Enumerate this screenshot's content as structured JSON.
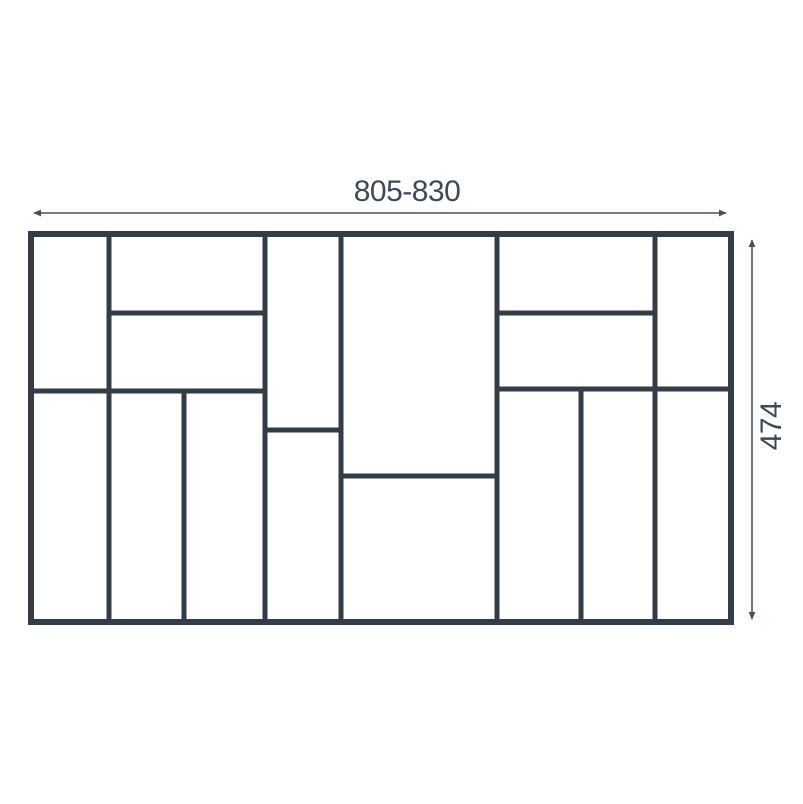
{
  "diagram": {
    "title": "cutlery tray compartment layout drawing",
    "width_dimension": "805-830",
    "height_dimension": "474",
    "compartment_count": 16,
    "colors": {
      "wall": "#333d47",
      "dimension_line": "#47515d",
      "label_text": "#3f4a59",
      "background": "#ffffff"
    },
    "outline": {
      "x": 31,
      "y": 234,
      "width": 700,
      "height": 388,
      "thickness": 6
    },
    "wall_thickness": 5,
    "walls": [
      {
        "name": "vertical-divider-1-full",
        "x1": 109,
        "y1": 234,
        "x2": 109,
        "y2": 622
      },
      {
        "name": "vertical-divider-2-lower",
        "x1": 184,
        "y1": 391,
        "x2": 184,
        "y2": 622
      },
      {
        "name": "vertical-divider-3-full",
        "x1": 265,
        "y1": 234,
        "x2": 265,
        "y2": 622
      },
      {
        "name": "vertical-divider-4-full",
        "x1": 341,
        "y1": 234,
        "x2": 341,
        "y2": 622
      },
      {
        "name": "vertical-divider-5-full",
        "x1": 497,
        "y1": 234,
        "x2": 497,
        "y2": 622
      },
      {
        "name": "vertical-divider-6-lower",
        "x1": 581,
        "y1": 389,
        "x2": 581,
        "y2": 622
      },
      {
        "name": "vertical-divider-7-full",
        "x1": 655,
        "y1": 234,
        "x2": 655,
        "y2": 622
      },
      {
        "name": "horizontal-divider-left-upper",
        "x1": 109,
        "y1": 313,
        "x2": 265,
        "y2": 313
      },
      {
        "name": "horizontal-divider-right-upper",
        "x1": 497,
        "y1": 313,
        "x2": 655,
        "y2": 313
      },
      {
        "name": "horizontal-divider-left-mid",
        "x1": 31,
        "y1": 391,
        "x2": 265,
        "y2": 391
      },
      {
        "name": "horizontal-divider-right-mid",
        "x1": 497,
        "y1": 389,
        "x2": 731,
        "y2": 389
      },
      {
        "name": "horizontal-divider-center-left",
        "x1": 265,
        "y1": 430,
        "x2": 341,
        "y2": 430
      },
      {
        "name": "horizontal-divider-center",
        "x1": 341,
        "y1": 476,
        "x2": 497,
        "y2": 476
      }
    ],
    "dimension_arrows": {
      "width": {
        "x1": 34,
        "y1": 213,
        "x2": 726,
        "y2": 213
      },
      "height": {
        "x1": 752,
        "y1": 240,
        "x2": 752,
        "y2": 619
      }
    }
  }
}
